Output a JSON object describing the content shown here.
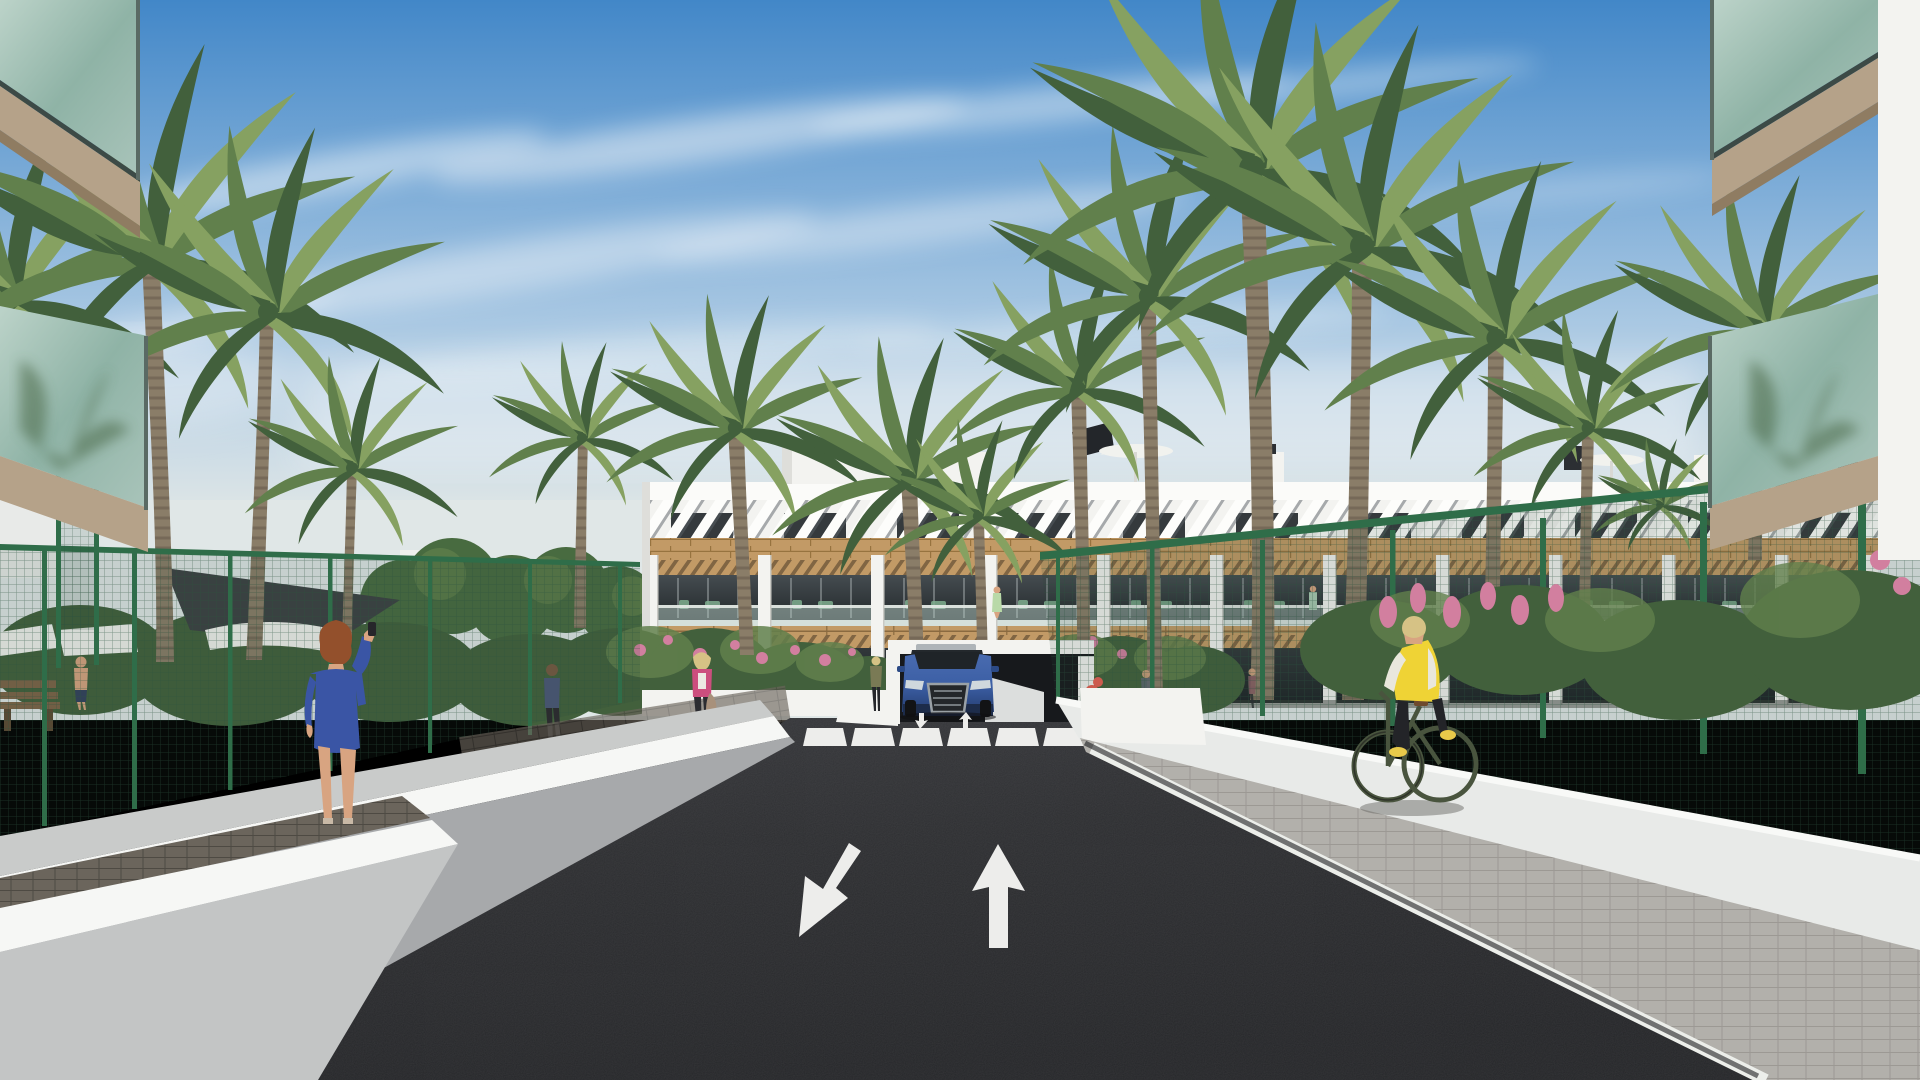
{
  "meta": {
    "title": "Residential complex exterior render",
    "type": "architectural-visualization",
    "description": "Street-level render of a Mediterranean apartment complex: dark asphalt access road with painted lane arrows leading to an underground garage where a blue SUV exits, zebra crosswalk, white perimeter ramp walls, green mesh fences, palm trees, and a three-storey white apartment block with wood accents and louvered roof pergolas under a blue sky with cirrus clouds."
  },
  "palette": {
    "sky_top": "#4287c8",
    "sky_mid": "#a9c8e3",
    "sky_horizon": "#e0e7e7",
    "cloud": "#f5f8fa",
    "building_white": "#f3f3f0",
    "fascia_white": "#fbfbf9",
    "building_shade": "#dededa",
    "louver_gap": "#596065",
    "wood": "#c29a66",
    "wood_dark": "#9c7544",
    "window_dark": "#353a3d",
    "ground_glass": "#2b3134",
    "glass_tint": "#b7cec6",
    "road": "#2b2c2f",
    "marking_white": "#ededeb",
    "wall_shade": "#a7a9ab",
    "wall_mid": "#c3c5c5",
    "wall_sun": "#e8eae8",
    "wall_top": "#f6f7f5",
    "walkway": "#c9cbca",
    "paver_dark": "#6b655c",
    "paver_light": "#b2b0ab",
    "paver_tan": "#a8917b",
    "fence_green": "#2f6d49",
    "fence_mesh": "#335c44",
    "foliage_dark": "#42603c",
    "foliage_mid": "#61804c",
    "foliage_light": "#86a161",
    "tree_green": "#486b40",
    "palm_trunk": "#8a7d68",
    "palm_trunk_dark": "#6e6353",
    "flower_pink": "#d27f9f",
    "flower_red": "#cc5b4e",
    "car_blue": "#3c5fa5",
    "car_blue_dark": "#263f73",
    "car_grille": "#9aa1a6",
    "garage": "#17191c",
    "shade_sail": "#3c4043",
    "parasol_white": "#f1f2ee",
    "bench_wood": "#7d6347",
    "skin": "#d8a481",
    "hair_auburn": "#93502c",
    "hair_blonde": "#d6c285",
    "dress_blue": "#3a55a5",
    "jacket_pink": "#cc4e7e",
    "jacket_olive": "#7a7a55",
    "pants_dark": "#2c2d31",
    "vest_yellow": "#efd335",
    "shirt_white": "#e9e7dc",
    "bike_green": "#49543e",
    "shoe_yellow": "#e8c94a"
  },
  "scene": {
    "objects": [
      {
        "id": "sky",
        "label": "blue sky with diagonal cirrus clouds"
      },
      {
        "id": "apartment-building",
        "label": "3-storey white apartment block, louvered roof pergolas, wood band, balcony pergolas"
      },
      {
        "id": "rooftop-parasol",
        "label": "white parasols and dark solar panel on roof terraces"
      },
      {
        "id": "palm-trees",
        "label": "tall palm trees framing and fronting the building"
      },
      {
        "id": "green-mesh-fence",
        "label": "green wire mesh fencing both sides"
      },
      {
        "id": "pool-area",
        "label": "left amenity area with white parasols, dark shade sail, wooden bench"
      },
      {
        "id": "road",
        "label": "dark asphalt access road"
      },
      {
        "id": "zebra-crosswalk",
        "label": "white zebra crosswalk, 6 stripes"
      },
      {
        "id": "lane-arrow-towards",
        "label": "white arrow painted on road pointing toward viewer (down-left)"
      },
      {
        "id": "lane-arrow-away",
        "label": "white arrow painted on road pointing away (up)"
      },
      {
        "id": "garage-entrance",
        "label": "underground parking entrance"
      },
      {
        "id": "blue-suv",
        "label": "blue SUV exiting garage ramp"
      },
      {
        "id": "ramp-walls",
        "label": "white/grey perimeter ramp walls both sides"
      },
      {
        "id": "sidewalk",
        "label": "grey paver sidewalk on right"
      },
      {
        "id": "foreground-balconies",
        "label": "glass-balustrade balconies of foreground buildings, top corners"
      }
    ],
    "people": [
      {
        "id": "woman-blue-dress",
        "label": "auburn-haired woman in blue patterned dress on phone, left walkway"
      },
      {
        "id": "woman-pink-jacket",
        "label": "blonde woman in pink jacket with tan handbag near crosswalk"
      },
      {
        "id": "woman-standing",
        "label": "woman in olive jacket standing beside garage ramp"
      },
      {
        "id": "cyclist",
        "label": "blonde cyclist in yellow vest on dark green bike, right sidewalk"
      },
      {
        "id": "man-walking",
        "label": "man walking on left garden path"
      },
      {
        "id": "man-pool",
        "label": "shirtless man in left pool area"
      },
      {
        "id": "balcony-residents",
        "label": "small figures on balconies"
      }
    ],
    "counts": {
      "crosswalk_stripes": 6,
      "road_arrows": 2,
      "building_floors": 3
    }
  }
}
